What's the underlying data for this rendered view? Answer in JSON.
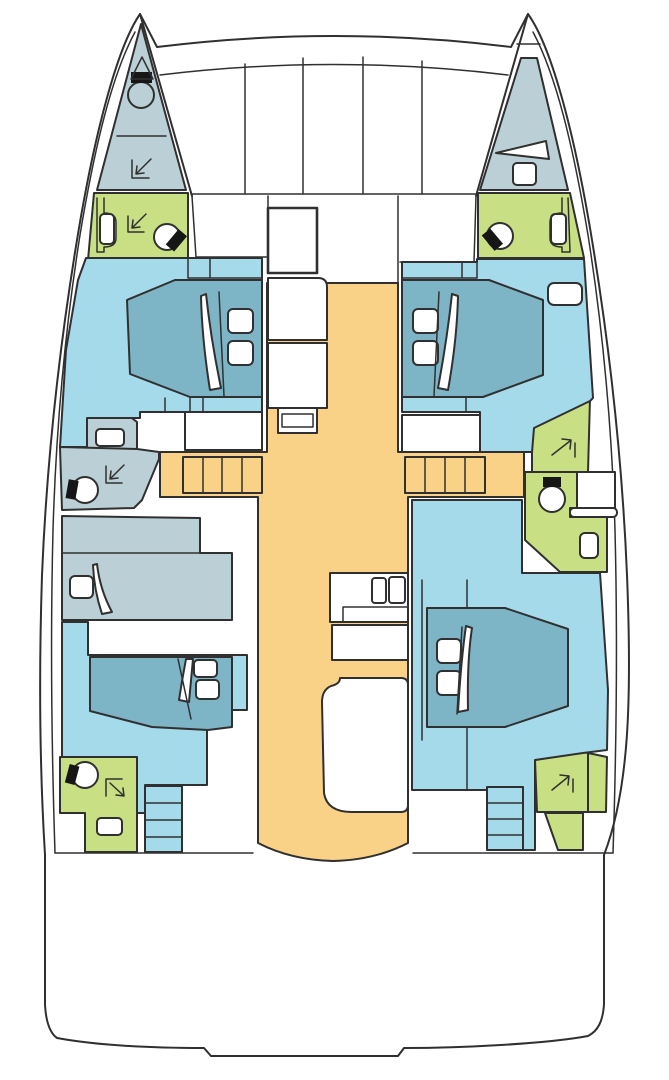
{
  "meta": {
    "title": "Catamaran yacht deck plan",
    "diagram_type": "floor-plan",
    "double_cabins": 4,
    "single_berths": 1,
    "heads": 4,
    "bow_compartments": 2
  },
  "colors": {
    "outline": "#303030",
    "boat_white": "#ffffff",
    "gray": "#bacfd6",
    "cabin": "#a5daeb",
    "bed": "#7db5c7",
    "head_green": "#c9df84",
    "walkway": "#f9d287",
    "fixture_white": "#ffffff",
    "hardware_black": "#161616"
  }
}
